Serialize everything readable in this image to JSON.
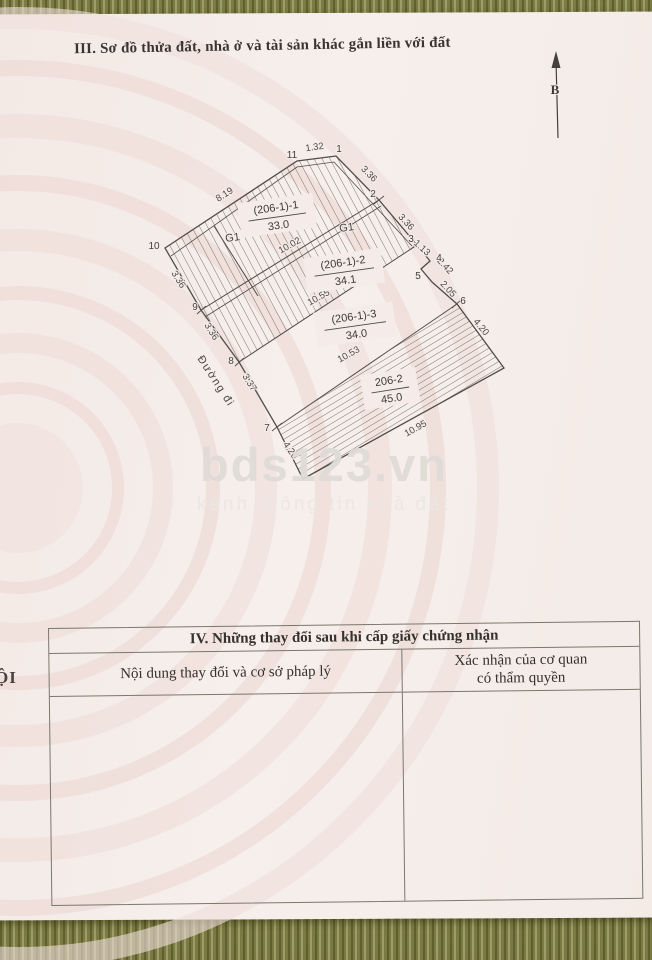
{
  "page": {
    "section3_title": "III. Sơ đồ thửa đất, nhà ở và tài sản khác gắn liền với đất",
    "edge_fragment": "ỘI"
  },
  "north": {
    "label": "B"
  },
  "watermark": {
    "brand": "bds123.vn",
    "tagline": "kênh thông tin nhà đất"
  },
  "diagram": {
    "road_label": "Đường đi",
    "house_labels": [
      {
        "id": "g1-left",
        "text": "G1"
      },
      {
        "id": "g1-right",
        "text": "G1"
      }
    ],
    "parcels": [
      {
        "id": "p1",
        "name": "(206-1)-1",
        "area": "33.0"
      },
      {
        "id": "p2",
        "name": "(206-1)-2",
        "area": "34.1"
      },
      {
        "id": "p3",
        "name": "(206-1)-3",
        "area": "34.0"
      },
      {
        "id": "p4",
        "name": "206-2",
        "area": "45.0"
      }
    ],
    "dimensions": [
      {
        "id": "d819",
        "text": "8.19"
      },
      {
        "id": "d132",
        "text": "1.32"
      },
      {
        "id": "d336a",
        "text": "3.36"
      },
      {
        "id": "d336b",
        "text": "3.36"
      },
      {
        "id": "d113",
        "text": "1.13"
      },
      {
        "id": "d242",
        "text": "2.42"
      },
      {
        "id": "d205",
        "text": "2.05"
      },
      {
        "id": "d420r",
        "text": "4.20"
      },
      {
        "id": "d1002",
        "text": "10.02"
      },
      {
        "id": "d1055",
        "text": "10.55"
      },
      {
        "id": "d1053",
        "text": "10.53"
      },
      {
        "id": "d1095",
        "text": "10.95"
      },
      {
        "id": "d420l",
        "text": "4.20"
      },
      {
        "id": "d336c",
        "text": "3.36"
      },
      {
        "id": "d336d",
        "text": "3.36"
      },
      {
        "id": "d337",
        "text": "3.37"
      }
    ],
    "vertices": [
      {
        "id": "v1",
        "text": "1"
      },
      {
        "id": "v2",
        "text": "2"
      },
      {
        "id": "v3",
        "text": "3"
      },
      {
        "id": "v4",
        "text": "4"
      },
      {
        "id": "v5",
        "text": "5"
      },
      {
        "id": "v6",
        "text": "6"
      },
      {
        "id": "v7",
        "text": "7"
      },
      {
        "id": "v8",
        "text": "8"
      },
      {
        "id": "v9",
        "text": "9"
      },
      {
        "id": "v10",
        "text": "10"
      },
      {
        "id": "v11",
        "text": "11"
      }
    ]
  },
  "table": {
    "section4_title": "IV. Những thay đổi sau khi cấp giấy chứng nhận",
    "col_content": "Nội dung thay đổi và cơ sở pháp lý",
    "col_confirm": "Xác nhận của cơ quan\ncó thẩm quyền"
  },
  "colors": {
    "paper": "#f5ece9",
    "carpet": "#85844c",
    "ink": "#4b4945",
    "emblem_pink": "#eed8d4"
  }
}
